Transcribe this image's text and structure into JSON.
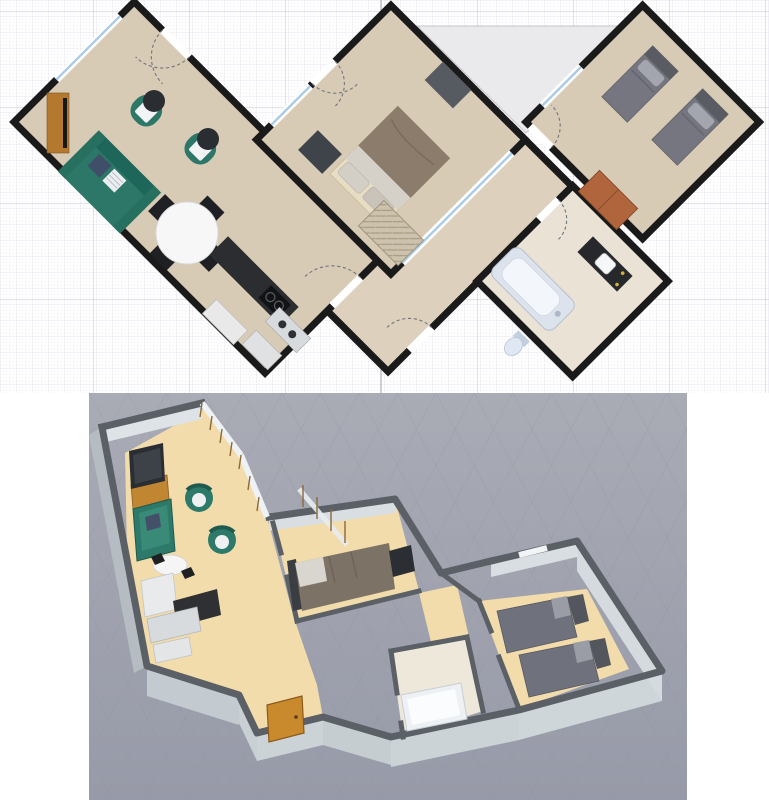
{
  "app": {
    "type": "floor-plan-designer",
    "views": [
      {
        "name": "plan-2d",
        "description": "2D floor plan with grid"
      },
      {
        "name": "view-3d",
        "description": "3D aerial view of apartment"
      }
    ]
  },
  "plan2d": {
    "colors": {
      "bg": "#ffffff",
      "grid_fine": "#ededf2",
      "grid_medium": "#e2e2ea",
      "grid_major": "#c6c6cf",
      "axis": "#9aa0a8",
      "wall": "#1a1a1a",
      "floor": "#d8cbb6",
      "hall_floor": "#ddd0bc",
      "bath_floor": "#e9e2d5",
      "terrace": "#eaeaec",
      "window_glass": "#a8cce8",
      "window_gap": "#fbfbfc",
      "door_arc": "#70757c"
    },
    "rooms": [
      {
        "name": "living-dining-kitchen"
      },
      {
        "name": "master-bedroom"
      },
      {
        "name": "second-bedroom"
      },
      {
        "name": "bathroom"
      },
      {
        "name": "entry-hall"
      },
      {
        "name": "terrace"
      }
    ],
    "furniture": {
      "tv_stand": "#b5782f",
      "tv": "#17181a",
      "sofa": "#2c7767",
      "sofa_back": "#1f665a",
      "pillow_navy": "#3f4f69",
      "pillow_white": "#eceff2",
      "armchair": "#2c7767",
      "chair_cushion": "#f2f3f5",
      "side_table": "#2a2d32",
      "dining_table": "#f7f7f7",
      "dining_chair": "#1e2023",
      "counter_dark": "#2b2d30",
      "stove": "#121315",
      "appliance_light": "#e9e9e9",
      "appliance_gray": "#d8dbde",
      "bed_frame": "#e7ddc4",
      "bed_duvet": "#8b7c6c",
      "bed_sheet": "#d6d1c8",
      "bed_pillow": "#d3cec6",
      "nightstand": "#33373c",
      "wardrobe_dark": "#3f444b",
      "dresser_gray": "#565b62",
      "single_bed": "#75767f",
      "single_bed_head": "#595c63",
      "single_bed_pillow": "#a3a6ae",
      "dresser_brown": "#b0653c",
      "tub_rim": "#dce3ed",
      "tub_inner": "#f3f6fa",
      "toilet": "#dee7f2",
      "vanity": "#26282b",
      "sink": "#f5f7f9",
      "hall_wardrobe": "#cdc2ad"
    }
  },
  "view3d": {
    "colors": {
      "bg_top": "#a9abb5",
      "bg_bottom": "#979aa8",
      "grid": "#8e919e",
      "wall_top": "#5b5f66",
      "wall_face": "#dde3e6",
      "wall_face_out": "#b6bdc2",
      "wall_face_front": "#ccd3d7",
      "floor_wood": "#f2dcab",
      "floor_bath": "#eee8db",
      "glass": "#eef2f4",
      "frame_wood": "#8a6a3a",
      "entry_door": "#c98a2e",
      "sofa": "#2e7a6a",
      "tv": "#2a2d31",
      "tv_stand": "#c08632",
      "table": "#f5f5f5",
      "counter": "#2e3033",
      "cabinet": "#e8eaec",
      "bed_duvet": "#7d7266",
      "bed_pillow": "#d9d6d0",
      "headboard": "#3a3d42",
      "desk": "#2b2e32",
      "single_bed": "#6f717c",
      "single_head": "#54565e",
      "tub": "#eef1f4"
    }
  }
}
